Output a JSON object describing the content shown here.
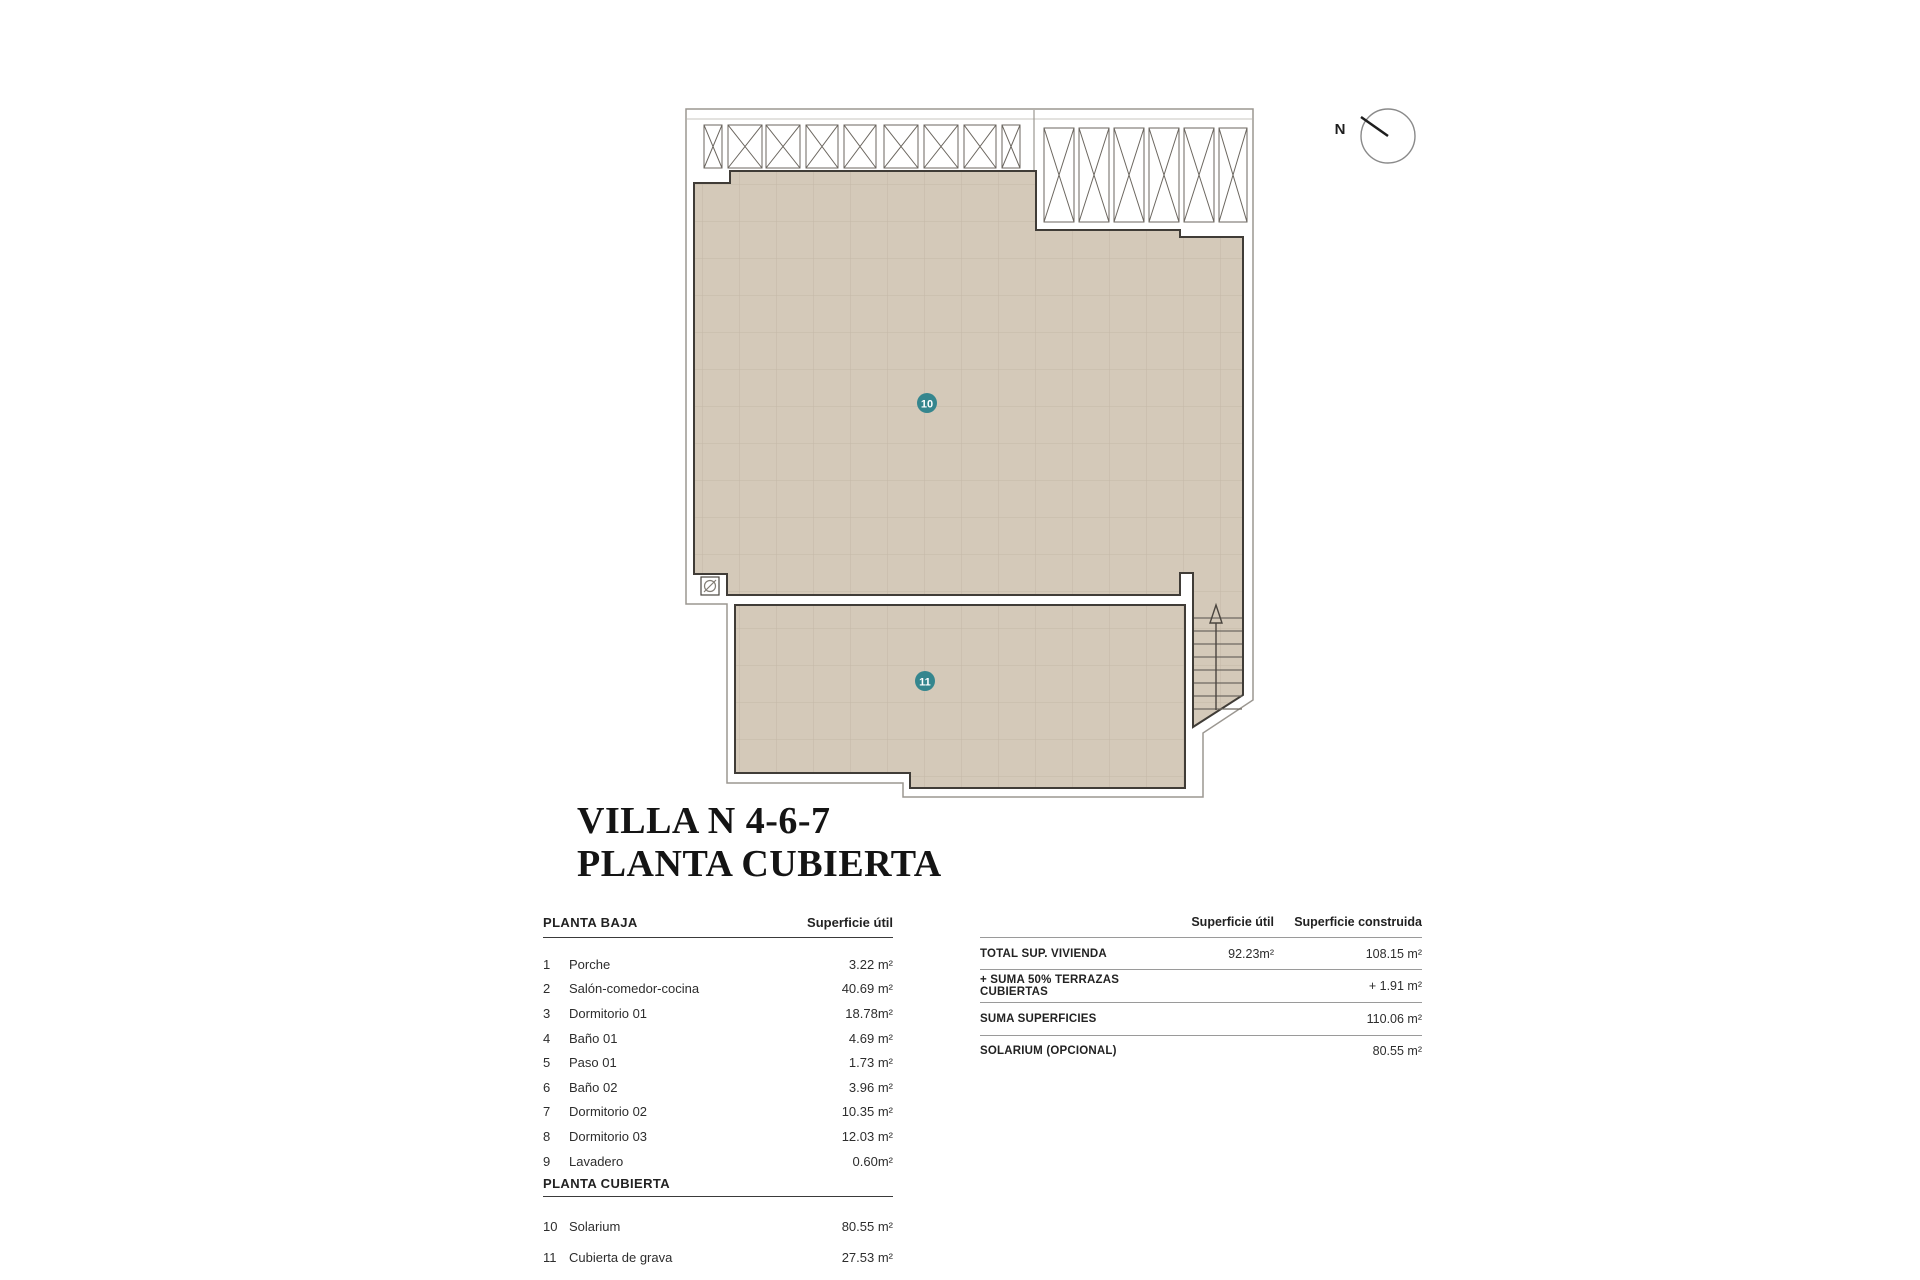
{
  "title": {
    "line1": "VILLA N 4-6-7",
    "line2": "PLANTA CUBIERTA"
  },
  "plan": {
    "north_label": "N",
    "badges": {
      "solarium": "10",
      "gravel_roof": "11"
    },
    "colors": {
      "floor_tan": "#d4c9b9",
      "grid_line": "#c5b9a8",
      "dark_outline": "#403c37",
      "boundary_gray": "#9b9791",
      "badge_teal": "#35868e"
    }
  },
  "left_table": {
    "section1_header": "PLANTA BAJA",
    "area_column_header": "Superficie útil",
    "rows": [
      {
        "num": "1",
        "name": "Porche",
        "value": "3.22 m²"
      },
      {
        "num": "2",
        "name": "Salón-comedor-cocina",
        "value": "40.69 m²"
      },
      {
        "num": "3",
        "name": "Dormitorio 01",
        "value": "18.78m²"
      },
      {
        "num": "4",
        "name": "Baño 01",
        "value": "4.69 m²"
      },
      {
        "num": "5",
        "name": "Paso 01",
        "value": "1.73 m²"
      },
      {
        "num": "6",
        "name": "Baño 02",
        "value": "3.96 m²"
      },
      {
        "num": "7",
        "name": "Dormitorio 02",
        "value": "10.35 m²"
      },
      {
        "num": "8",
        "name": "Dormitorio 03",
        "value": "12.03 m²"
      },
      {
        "num": "9",
        "name": "Lavadero",
        "value": "0.60m²"
      }
    ],
    "section2_header": "PLANTA CUBIERTA",
    "rows2": [
      {
        "num": "10",
        "name": "Solarium",
        "value": "80.55 m²"
      },
      {
        "num": "11",
        "name": "Cubierta de grava",
        "value": "27.53 m²"
      }
    ]
  },
  "right_table": {
    "col_util": "Superficie útil",
    "col_construida": "Superficie construida",
    "rows": [
      {
        "label": "TOTAL SUP. VIVIENDA",
        "util": "92.23m²",
        "construida": "108.15 m²"
      },
      {
        "label": "+ SUMA 50% TERRAZAS CUBIERTAS",
        "util": "",
        "construida": "+ 1.91 m²"
      },
      {
        "label": "SUMA SUPERFICIES",
        "util": "",
        "construida": "110.06 m²"
      },
      {
        "label": "SOLARIUM (OPCIONAL)",
        "util": "",
        "construida": "80.55 m²"
      }
    ]
  }
}
